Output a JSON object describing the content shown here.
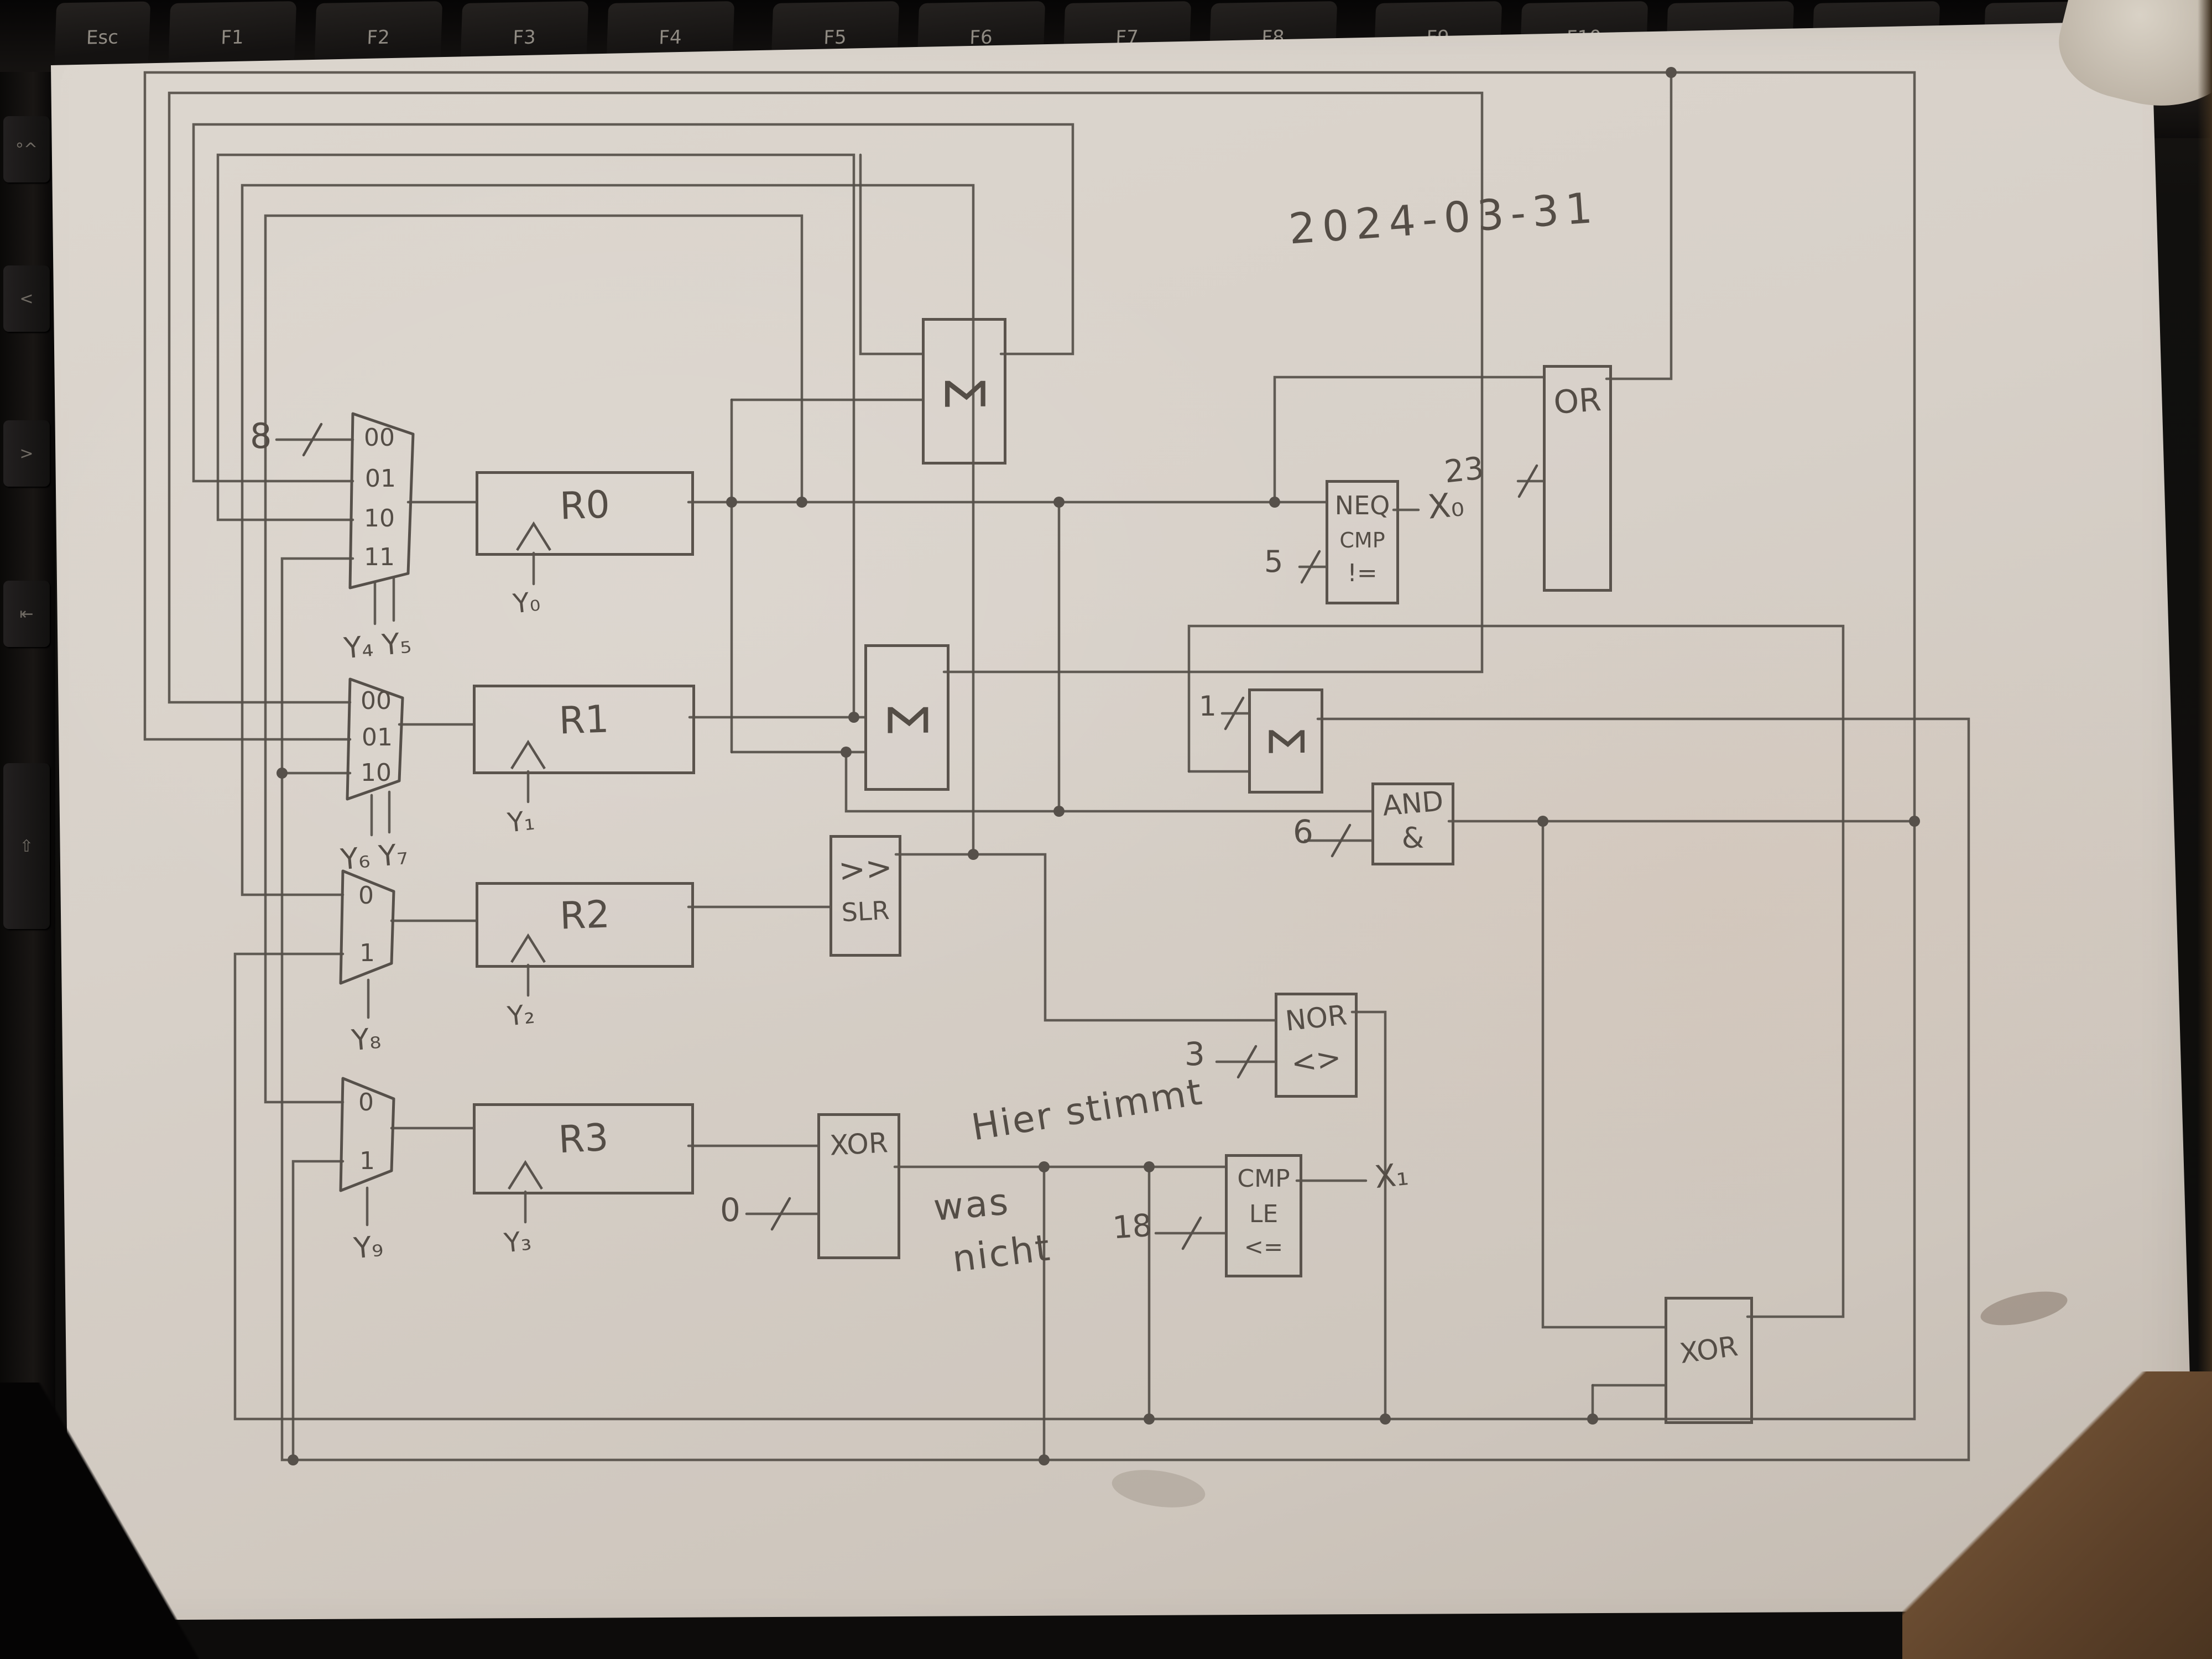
{
  "meta": {
    "date_note": "2024-03-31"
  },
  "notes": {
    "line1": "Hier stimmt",
    "line2": "was",
    "line3": "nicht"
  },
  "keyboard": {
    "keys": [
      "Esc",
      "F1",
      "F2",
      "F3",
      "F4",
      "F5",
      "F6",
      "F7",
      "F8",
      "F9",
      "F10",
      "F11",
      "F12",
      "Entf"
    ]
  },
  "side_keys": {
    "glyphs": [
      "°^",
      "<",
      ">",
      "⇤",
      "⇧"
    ]
  },
  "registers": {
    "r0": {
      "label": "R0",
      "clock": "Y₀"
    },
    "r1": {
      "label": "R1",
      "clock": "Y₁"
    },
    "r2": {
      "label": "R2",
      "clock": "Y₂"
    },
    "r3": {
      "label": "R3",
      "clock": "Y₃"
    }
  },
  "muxes": {
    "mux1": {
      "ports": [
        "00",
        "01",
        "10",
        "11"
      ],
      "select": "Y₄ Y₅"
    },
    "mux2": {
      "ports": [
        "00",
        "01",
        "10"
      ],
      "select": "Y₆ Y₇"
    },
    "mux3": {
      "ports": [
        "0",
        "1"
      ],
      "select": "Y₈"
    },
    "mux4": {
      "ports": [
        "0",
        "1"
      ],
      "select": "Y₉"
    }
  },
  "alu": {
    "sigma": "Σ",
    "slr_line1": ">>",
    "slr_line2": "SLR",
    "xor": "XOR"
  },
  "gates": {
    "or": "OR",
    "and_line1": "AND",
    "and_line2": "&",
    "nor_line1": "NOR",
    "nor_line2": "<>"
  },
  "comparators": {
    "neq": {
      "l1": "NEQ",
      "l2": "CMP",
      "l3": "!="
    },
    "le": {
      "l1": "CMP",
      "l2": "LE",
      "l3": "<="
    }
  },
  "constants": {
    "mux1": "8",
    "neq": "5",
    "or": "23",
    "sigma3": "1",
    "and": "6",
    "nor": "3",
    "le": "18",
    "xor1": "0"
  },
  "outputs": {
    "x0": "X₀",
    "x1": "X₁"
  },
  "colors": {
    "pencil": "#56504a",
    "paper": "#d8d1c9",
    "key": "#1b1918",
    "key_label": "#8f8a82",
    "table": "#63492f"
  }
}
